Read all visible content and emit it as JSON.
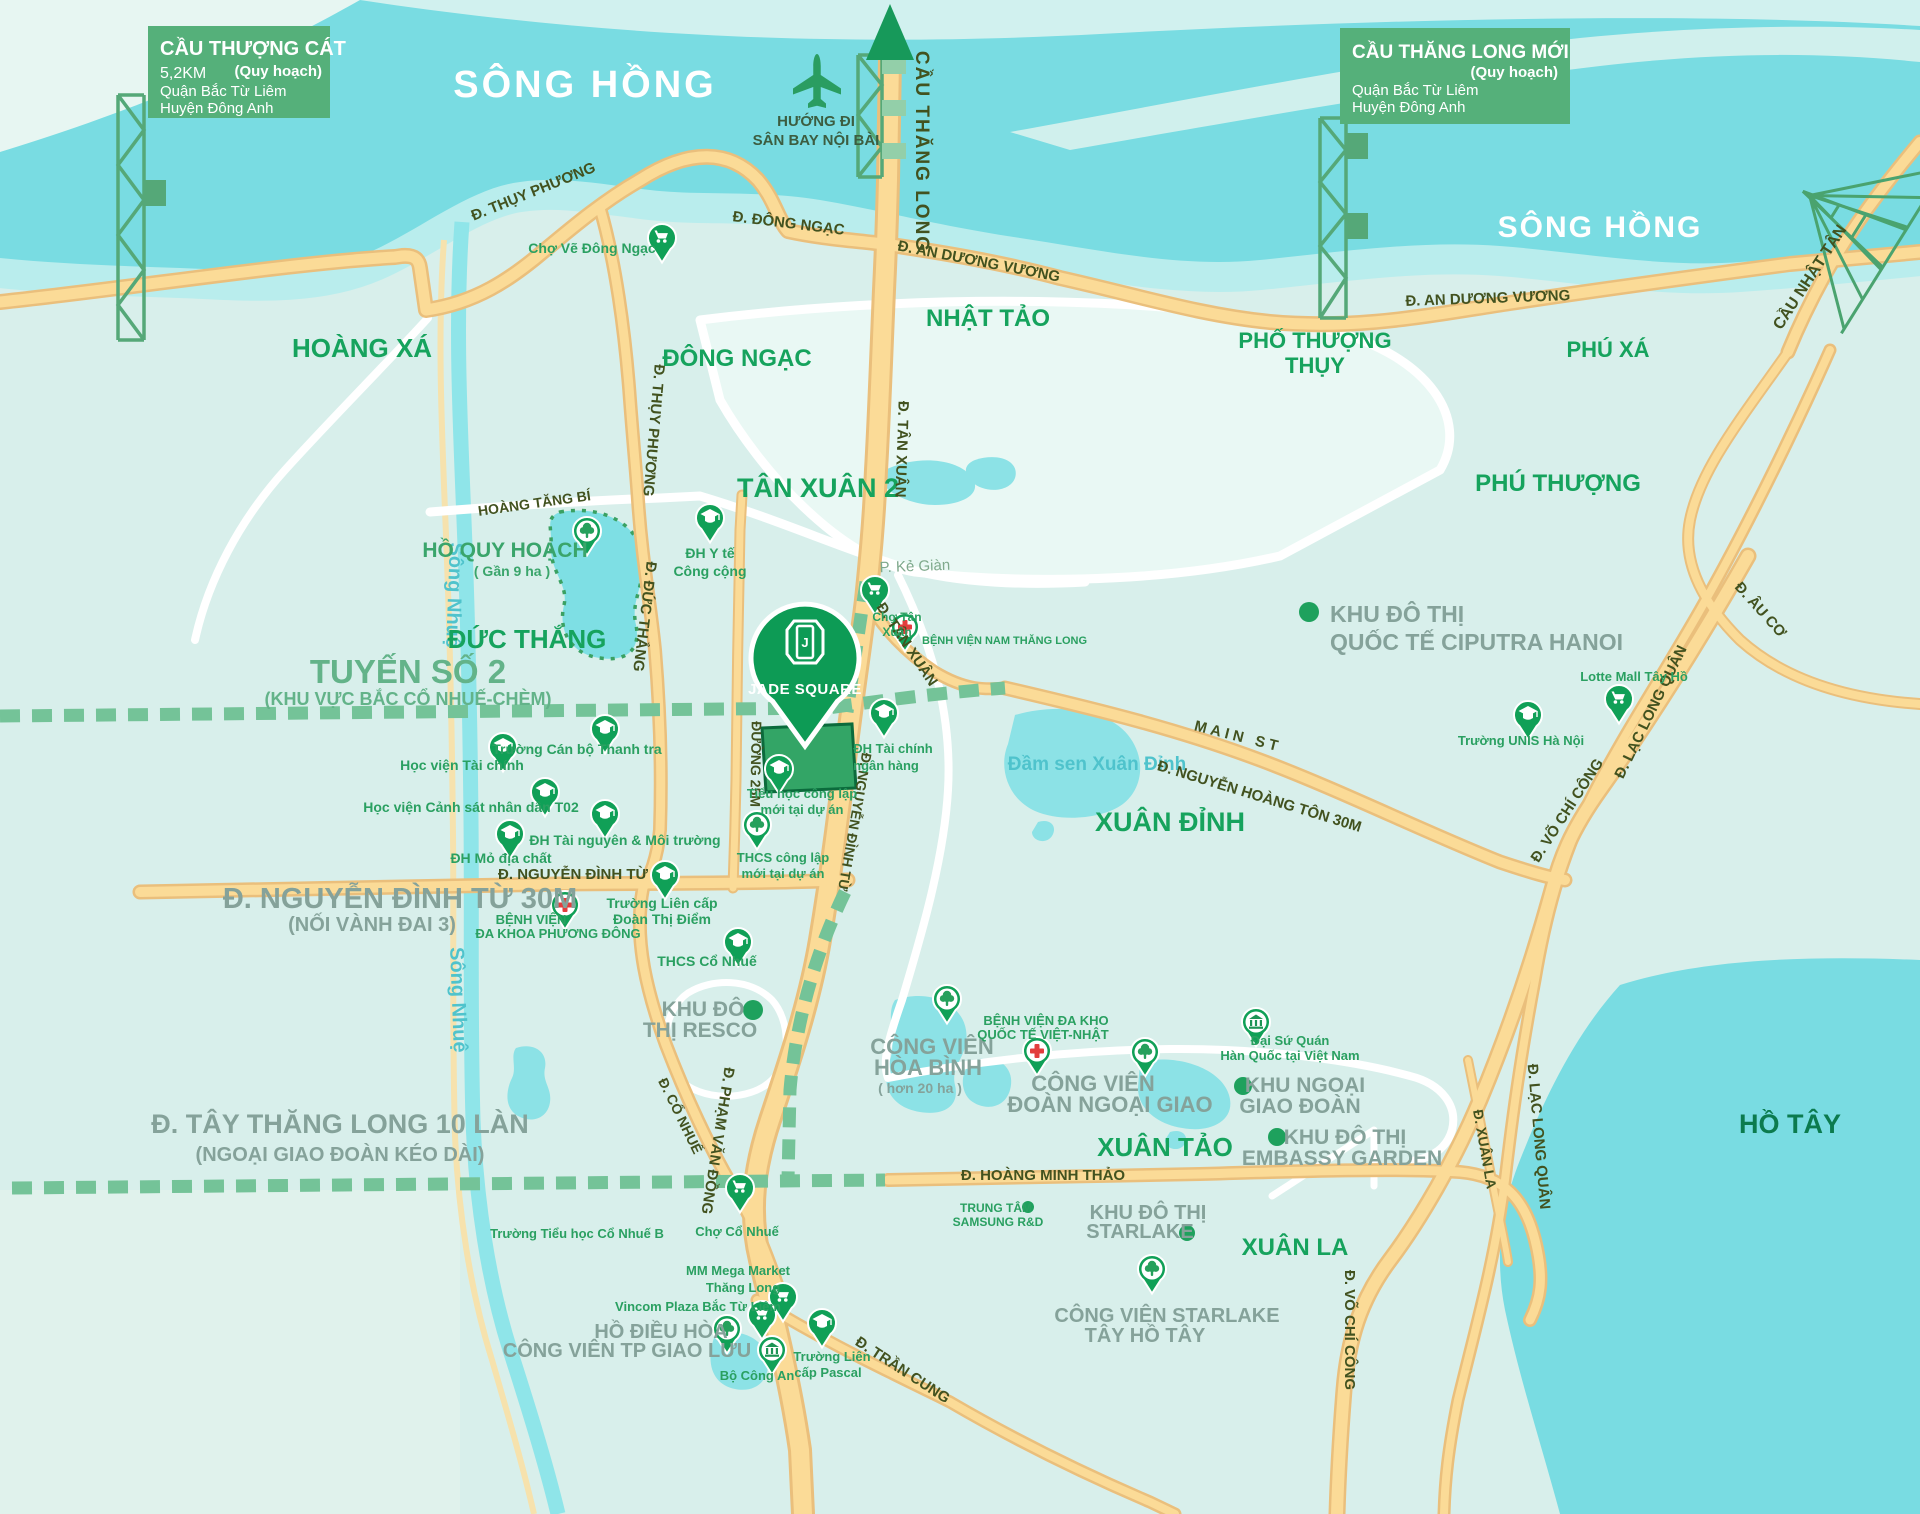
{
  "signs": {
    "left": {
      "title": "CẦU THƯỢNG CÁT",
      "planning": "(Quy hoạch)",
      "distance": "5,2KM",
      "district": "Quận Bắc Từ Liêm",
      "county": "Huyện Đông Anh"
    },
    "right": {
      "title": "CẦU THĂNG LONG MỚI",
      "planning": "(Quy hoạch)",
      "district": "Quận Bắc Từ Liêm",
      "county": "Huyện Đông Anh"
    }
  },
  "water": {
    "song_hong": "SÔNG HỒNG",
    "song_nhue": "Sông Nhuệ",
    "ho_tay": "HỒ TÂY",
    "dam_sen": "Đầm sen Xuân Đỉnh"
  },
  "airport": {
    "line1": "HƯỚNG ĐI",
    "line2": "SÂN BAY NỘI BÀI"
  },
  "areas": {
    "hoang_xa": "HOÀNG XÁ",
    "dong_ngac": "ĐÔNG NGẠC",
    "nhat_tao": "NHẬT TẢO",
    "pho_thuong_1": "PHỐ THƯỢNG",
    "pho_thuong_2": "THỤY",
    "phu_xa": "PHÚ XÁ",
    "phu_thuong": "PHÚ THƯỢNG",
    "tan_xuan_2": "TÂN XUÂN 2",
    "duc_thang": "ĐỨC THẮNG",
    "xuan_dinh": "XUÂN ĐỈNH",
    "xuan_tao": "XUÂN TẢO",
    "xuan_la": "XUÂN LA"
  },
  "roads": {
    "thuy_phuong": "Đ. THỤY PHƯƠNG",
    "dong_ngac": "Đ. ĐÔNG NGẠC",
    "an_duong_vuong": "Đ. AN DƯƠNG VƯƠNG",
    "cau_thang_long": "CẦU THĂNG LONG",
    "cau_nhat_tan": "CẦU NHẬT TÂN",
    "tan_xuan": "Đ. TÂN XUÂN",
    "duc_thang": "Đ. ĐỨC THẮNG",
    "duong_25m": "ĐƯỜNG 25M",
    "nguyen_dinh_tu": "Đ. NGUYỄN ĐÌNH TỪ",
    "main_st": "MAIN ST",
    "nguyen_hoang_ton": "Đ. NGUYỄN HOÀNG TÔN 30M",
    "au_co": "Đ. ÂU CƠ",
    "lac_long_quan": "Đ. LẠC LONG QUÂN",
    "vo_chi_cong": "Đ. VÕ CHÍ CÔNG",
    "xuan_la": "Đ. XUÂN LA",
    "co_nhue": "Đ. CỔ NHUẾ",
    "pham_van_dong": "Đ. PHẠM VĂN ĐỒNG",
    "hoang_minh_thao": "Đ. HOÀNG MINH THẢO",
    "tran_cung": "Đ. TRẦN CUNG",
    "hoang_tang_bi": "HOÀNG TĂNG BÍ",
    "ke_gian": "P. Kẻ Giàn"
  },
  "callouts": {
    "tuyen2_line1": "TUYẾN SỐ 2",
    "tuyen2_line2": "(KHU VỰC BẮC CỔ NHUẾ-CHÈM)",
    "ndt30_line1": "Đ. NGUYỄN ĐÌNH TỪ 30M",
    "ndt30_line2": "(NỐI VÀNH ĐAI 3)",
    "ttl10_line1": "Đ. TÂY THĂNG LONG 10 LÀN",
    "ttl10_line2": "(NGOẠI GIAO ĐOÀN KÉO DÀI)"
  },
  "project": {
    "name": "JADE SQUARE"
  },
  "pois": {
    "cho_ve": {
      "name": "Chợ Vẽ Đông Ngạc"
    },
    "dh_y_te": {
      "line1": "ĐH Y tế",
      "line2": "Công cộng"
    },
    "cho_tan_xuan": {
      "line1": "Chợ Tân",
      "line2": "Xuân"
    },
    "bv_nam_thang_long": {
      "name": "BỆNH VIỆN NAM THĂNG LONG"
    },
    "ho_quy_hoach": {
      "line1": "HỒ QUY HOẠCH",
      "line2": "( Gần 9 ha )"
    },
    "hv_tai_chinh": {
      "name": "Học viện Tài chính"
    },
    "can_bo_thanh_tra": {
      "name": "Trường Cán bộ Thanh tra"
    },
    "canh_sat": {
      "name": "Học viện Cảnh sát nhân dân T02"
    },
    "tai_nguyen": {
      "name": "ĐH Tài nguyên & Môi trường"
    },
    "mo_dia_chat": {
      "name": "ĐH Mỏ địa chất"
    },
    "tc_ngan_hang": {
      "line1": "ĐH Tài chính",
      "line2": "ngân hàng"
    },
    "tieu_hoc_du_an": {
      "line1": "Tiểu học công lập",
      "line2": "mới tại dự án"
    },
    "thcs_du_an": {
      "line1": "THCS công lập",
      "line2": "mới tại dự án"
    },
    "bv_phuong_dong": {
      "line1": "BỆNH VIỆN",
      "line2": "ĐA KHOA PHƯƠNG ĐÔNG"
    },
    "doan_thi_diem": {
      "line1": "Trường Liên cấp",
      "line2": "Đoàn Thị Điểm"
    },
    "thcs_co_nhue": {
      "name": "THCS Cổ Nhuế"
    },
    "resco": {
      "line1": "KHU ĐÔ",
      "line2": "THỊ RESCO"
    },
    "hoa_binh": {
      "line1": "CÔNG VIÊN",
      "line2": "HÒA BÌNH",
      "line3": "( hơn 20 ha )"
    },
    "viet_nhat": {
      "line1": "BỆNH VIỆN ĐA KHO",
      "line2": "QUỐC TẾ VIỆT-NHẬT"
    },
    "doan_ngoai_giao": {
      "line1": "CÔNG VIÊN",
      "line2": "ĐOÀN NGOẠI GIAO"
    },
    "dai_su_quan": {
      "line1": "Đại Sứ Quán",
      "line2": "Hàn Quốc tại Việt Nam"
    },
    "ngoai_giao_doan": {
      "line1": "KHU NGOẠI",
      "line2": "GIAO ĐOÀN"
    },
    "embassy_garden": {
      "line1": "KHU ĐÔ THỊ",
      "line2": "EMBASSY GARDEN"
    },
    "samsung": {
      "line1": "TRUNG TÂM",
      "line2": "SAMSUNG R&D"
    },
    "starlake_kdt": {
      "line1": "KHU ĐÔ THỊ",
      "line2": "STARLAKE"
    },
    "cv_starlake": {
      "line1": "CÔNG VIÊN STARLAKE",
      "line2": "TÂY HỒ TÂY"
    },
    "tieu_hoc_co_nhue_b": {
      "name": "Trường Tiểu học Cổ Nhuế B"
    },
    "cho_co_nhue": {
      "name": "Chợ Cổ Nhuế"
    },
    "mm_mega": {
      "line1": "MM Mega Market",
      "line2": "Thăng Long"
    },
    "vincom": {
      "name": "Vincom Plaza Bắc Từ Liêm"
    },
    "ho_dieu_hoa": {
      "line1": "HỒ ĐIỀU HÒA",
      "line2": "CÔNG VIÊN TP GIAO LƯU"
    },
    "bo_cong_an": {
      "name": "Bộ Công An"
    },
    "pascal": {
      "line1": "Trường Liên",
      "line2": "cấp Pascal"
    },
    "unis": {
      "name": "Trường UNIS Hà Nội"
    },
    "lotte": {
      "name": "Lotte Mall Tây Hồ"
    },
    "ciputra": {
      "line1": "KHU ĐÔ THỊ",
      "line2": "QUỐC TẾ CIPUTRA HANOI"
    }
  },
  "colors": {
    "brand_green": "#109e57",
    "water": "#79dce2",
    "road_fill": "#fbdb97",
    "road_casing": "#eabf7c",
    "dash_green": "#74c398",
    "sign_green": "#55b07a",
    "label_green": "#16a35d",
    "label_grey": "#85a29a",
    "road_text": "#42521f",
    "hospital_red": "#e23d3d"
  }
}
